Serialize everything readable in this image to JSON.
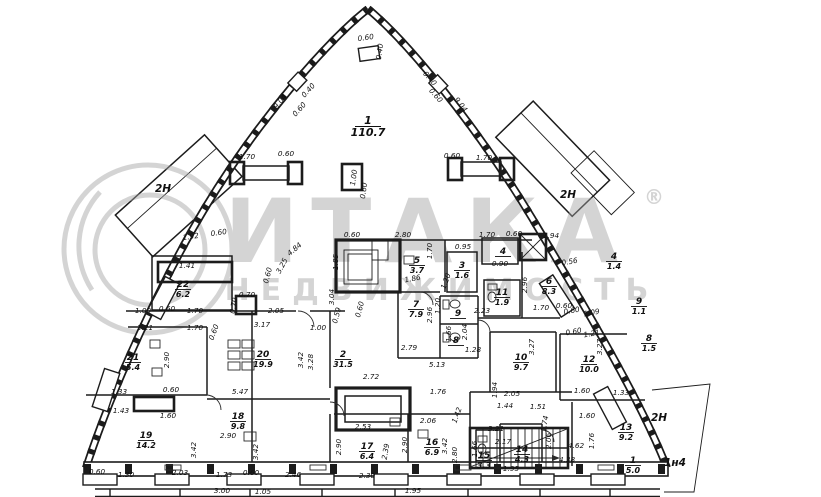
{
  "watermark": {
    "brand": "ИТАКА",
    "reg": "®",
    "subtitle": "НЕДВИЖИМОСТЬ"
  },
  "zones": [
    [
      "2Н",
      163,
      192,
      0
    ],
    [
      "2Н",
      568,
      198,
      0
    ],
    [
      "2Н",
      659,
      421,
      0
    ],
    [
      "1н4",
      675,
      466,
      0
    ]
  ],
  "rooms": [
    {
      "n": "1",
      "a": "110.7",
      "x": 368,
      "y": 124,
      "big": true
    },
    {
      "n": "2",
      "a": "31.5",
      "x": 343,
      "y": 357
    },
    {
      "n": "3",
      "a": "1.6",
      "x": 462,
      "y": 268
    },
    {
      "n": "4",
      "x": 503,
      "y": 254
    },
    {
      "n": "5",
      "a": "3.7",
      "x": 417,
      "y": 263
    },
    {
      "n": "6",
      "a": "8.3",
      "x": 549,
      "y": 284
    },
    {
      "n": "7",
      "a": "7.9",
      "x": 416,
      "y": 307
    },
    {
      "n": "8",
      "x": 456,
      "y": 343
    },
    {
      "n": "9",
      "x": 458,
      "y": 316
    },
    {
      "n": "10",
      "a": "9.7",
      "x": 521,
      "y": 360
    },
    {
      "n": "11",
      "a": "1.9",
      "x": 502,
      "y": 295
    },
    {
      "n": "12",
      "a": "10.0",
      "x": 589,
      "y": 362
    },
    {
      "n": "13",
      "a": "9.2",
      "x": 626,
      "y": 430
    },
    {
      "n": "14",
      "a": "4.3",
      "x": 522,
      "y": 452
    },
    {
      "n": "15",
      "a": "3.3",
      "x": 484,
      "y": 458
    },
    {
      "n": "16",
      "a": "6.9",
      "x": 432,
      "y": 445
    },
    {
      "n": "17",
      "a": "6.4",
      "x": 367,
      "y": 449
    },
    {
      "n": "18",
      "a": "9.8",
      "x": 238,
      "y": 419
    },
    {
      "n": "19",
      "a": "14.2",
      "x": 146,
      "y": 438
    },
    {
      "n": "20",
      "a": "19.9",
      "x": 263,
      "y": 357
    },
    {
      "n": "21",
      "a": "5.4",
      "x": 133,
      "y": 360
    },
    {
      "n": "22",
      "a": "6.2",
      "x": 183,
      "y": 287
    },
    {
      "n": "4",
      "a": "1.4",
      "x": 614,
      "y": 259
    },
    {
      "n": "9",
      "a": "1.1",
      "x": 639,
      "y": 304
    },
    {
      "n": "8",
      "a": "1.5",
      "x": 649,
      "y": 341
    },
    {
      "n": "1",
      "a": "5.0",
      "x": 633,
      "y": 463
    }
  ],
  "dimensions": [
    [
      "0.60",
      366,
      40,
      -8
    ],
    [
      "0.40",
      382,
      52,
      -82
    ],
    [
      "0.40",
      310,
      92,
      -48
    ],
    [
      "0.60",
      301,
      111,
      -48
    ],
    [
      "9.04",
      282,
      103,
      -52
    ],
    [
      "0.40",
      428,
      80,
      48
    ],
    [
      "0.60",
      434,
      97,
      48
    ],
    [
      "9.04",
      459,
      106,
      52
    ],
    [
      "1.70",
      247,
      159,
      0
    ],
    [
      "0.60",
      286,
      156,
      0
    ],
    [
      "1.00",
      356,
      178,
      -82
    ],
    [
      "0.60",
      366,
      191,
      -82
    ],
    [
      "0.60",
      452,
      158,
      0
    ],
    [
      "1.70",
      484,
      160,
      0
    ],
    [
      "1.92",
      191,
      239,
      -8
    ],
    [
      "0.60",
      219,
      235,
      -8
    ],
    [
      "1.41",
      187,
      268,
      0
    ],
    [
      "4.84",
      296,
      251,
      -40
    ],
    [
      "3.25",
      284,
      267,
      -62
    ],
    [
      "0.60",
      270,
      276,
      -75
    ],
    [
      "1.85",
      338,
      262,
      -90
    ],
    [
      "0.60",
      352,
      237,
      0
    ],
    [
      "2.80",
      403,
      237,
      0
    ],
    [
      "1.70",
      432,
      251,
      -90
    ],
    [
      "1.70",
      487,
      237,
      0
    ],
    [
      "0.60",
      514,
      236,
      0
    ],
    [
      "1.94",
      551,
      238,
      0
    ],
    [
      "0.95",
      463,
      249,
      0
    ],
    [
      "0.90",
      500,
      266,
      0
    ],
    [
      "1.86",
      413,
      281,
      -10
    ],
    [
      "1.20",
      448,
      282,
      -70
    ],
    [
      "0.56",
      570,
      264,
      -10
    ],
    [
      "2.96",
      527,
      285,
      -90
    ],
    [
      "2.96",
      432,
      315,
      -90
    ],
    [
      "1.09",
      143,
      313,
      0
    ],
    [
      "0.60",
      167,
      311,
      0
    ],
    [
      "1.70",
      195,
      313,
      0
    ],
    [
      "1.21",
      145,
      330,
      0
    ],
    [
      "1.70",
      195,
      330,
      0
    ],
    [
      "0.60",
      216,
      333,
      -70
    ],
    [
      "0.70",
      247,
      297,
      0
    ],
    [
      "0.70",
      236,
      306,
      -80
    ],
    [
      "2.05",
      276,
      313,
      0
    ],
    [
      "3.17",
      262,
      327,
      0
    ],
    [
      "1.00",
      318,
      330,
      0
    ],
    [
      "0.59",
      339,
      316,
      -75
    ],
    [
      "0.60",
      362,
      310,
      -75
    ],
    [
      "3.04",
      334,
      297,
      -90
    ],
    [
      "2.23",
      482,
      313,
      0
    ],
    [
      "1.20",
      440,
      306,
      -90
    ],
    [
      "1.66",
      451,
      334,
      -90
    ],
    [
      "2.04",
      467,
      332,
      -90
    ],
    [
      "1.28",
      473,
      352,
      0
    ],
    [
      "2.79",
      409,
      350,
      0
    ],
    [
      "5.13",
      437,
      367,
      0
    ],
    [
      "2.72",
      371,
      379,
      0
    ],
    [
      "1.70",
      541,
      310,
      0
    ],
    [
      "0.60",
      564,
      308,
      0
    ],
    [
      "0.60",
      572,
      313,
      -10
    ],
    [
      "1.09",
      592,
      315,
      -10
    ],
    [
      "0.60",
      574,
      334,
      -10
    ],
    [
      "1.21",
      592,
      336,
      -10
    ],
    [
      "3.27",
      534,
      347,
      -90
    ],
    [
      "3.27",
      602,
      347,
      -90
    ],
    [
      "2.90",
      169,
      360,
      -90
    ],
    [
      "3.42",
      303,
      360,
      -90
    ],
    [
      "3.28",
      313,
      362,
      -90
    ],
    [
      "1.33",
      119,
      394,
      0
    ],
    [
      "1.43",
      121,
      413,
      0
    ],
    [
      "0.60",
      171,
      392,
      0
    ],
    [
      "1.60",
      168,
      418,
      0
    ],
    [
      "5.47",
      240,
      394,
      0
    ],
    [
      "2.90",
      228,
      438,
      0
    ],
    [
      "3.42",
      196,
      450,
      -90
    ],
    [
      "3.42",
      258,
      452,
      -90
    ],
    [
      "2.53",
      363,
      429,
      0
    ],
    [
      "2.39",
      388,
      452,
      -80
    ],
    [
      "2.90",
      341,
      447,
      -90
    ],
    [
      "2.90",
      407,
      445,
      -90
    ],
    [
      "1.76",
      438,
      394,
      0
    ],
    [
      "2.06",
      428,
      423,
      0
    ],
    [
      "1.42",
      459,
      416,
      -70
    ],
    [
      "3.42",
      447,
      446,
      -90
    ],
    [
      "2.80",
      457,
      455,
      -90
    ],
    [
      "1.66",
      477,
      449,
      -90
    ],
    [
      "3.21",
      496,
      431,
      0
    ],
    [
      "2.17",
      503,
      444,
      0
    ],
    [
      "1.94",
      497,
      390,
      -90
    ],
    [
      "2.05",
      512,
      396,
      0
    ],
    [
      "1.44",
      505,
      408,
      0
    ],
    [
      "1.51",
      538,
      409,
      0
    ],
    [
      "1.74",
      547,
      424,
      -80
    ],
    [
      "2.06",
      551,
      441,
      -90
    ],
    [
      "1.60",
      582,
      393,
      0
    ],
    [
      "1.33",
      621,
      395,
      0
    ],
    [
      "1.60",
      587,
      418,
      0
    ],
    [
      "1.76",
      594,
      441,
      -90
    ],
    [
      "4.62",
      576,
      448,
      0
    ],
    [
      "4.38",
      567,
      462,
      0
    ],
    [
      "1.95",
      511,
      471,
      0
    ],
    [
      "0.60",
      97,
      474,
      0
    ],
    [
      "1.30",
      126,
      477,
      0
    ],
    [
      "2.03",
      180,
      475,
      0
    ],
    [
      "1.73",
      224,
      477,
      0
    ],
    [
      "0.60",
      251,
      475,
      0
    ],
    [
      "2.46",
      293,
      477,
      0
    ],
    [
      "2.30",
      367,
      478,
      0
    ],
    [
      "3.00",
      222,
      493,
      0
    ],
    [
      "1.05",
      263,
      494,
      0
    ],
    [
      "1.95",
      413,
      493,
      0
    ]
  ]
}
